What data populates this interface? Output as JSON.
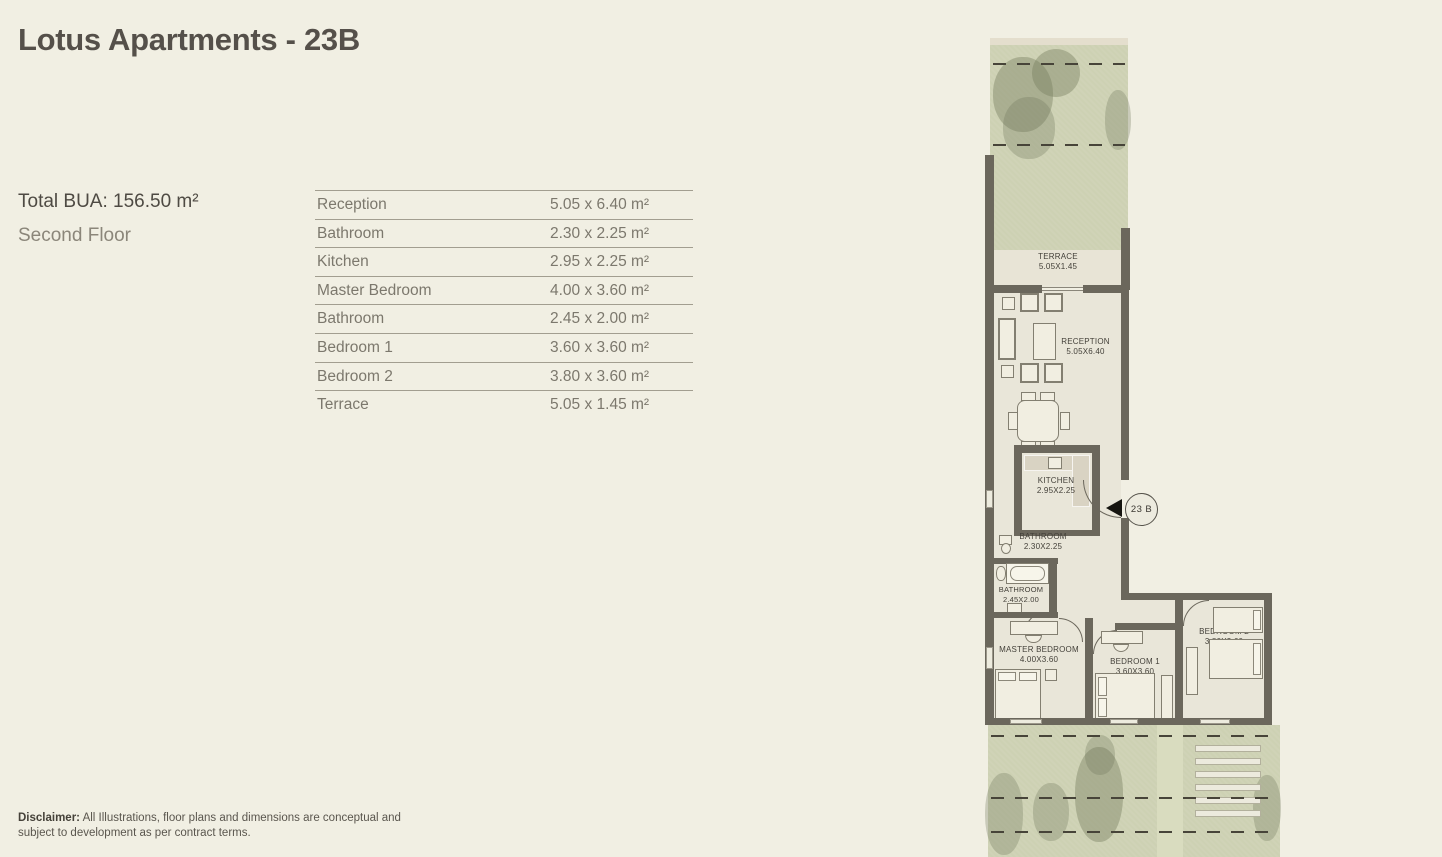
{
  "header": {
    "title": "Lotus Apartments - 23B"
  },
  "summary": {
    "total_bua": "Total BUA: 156.50 m²",
    "floor": "Second Floor"
  },
  "dimensions_table": {
    "rows": [
      {
        "label": "Reception",
        "value": "5.05 x 6.40 m²"
      },
      {
        "label": "Bathroom",
        "value": "2.30 x 2.25 m²"
      },
      {
        "label": "Kitchen",
        "value": "2.95 x 2.25 m²"
      },
      {
        "label": "Master Bedroom",
        "value": "4.00 x 3.60 m²"
      },
      {
        "label": "Bathroom",
        "value": "2.45 x 2.00 m²"
      },
      {
        "label": "Bedroom 1",
        "value": "3.60 x 3.60 m²"
      },
      {
        "label": "Bedroom 2",
        "value": "3.80 x 3.60 m²"
      },
      {
        "label": "Terrace",
        "value": "5.05 x 1.45 m²"
      }
    ]
  },
  "disclaimer": {
    "label": "Disclaimer:",
    "text": " All Illustrations, floor plans and dimensions are conceptual and subject to development as per contract terms."
  },
  "floor_plan": {
    "unit_badge": "23 B",
    "rooms": [
      {
        "name": "TERRACE",
        "dims": "5.05X1.45"
      },
      {
        "name": "RECEPTION",
        "dims": "5.05X6.40"
      },
      {
        "name": "KITCHEN",
        "dims": "2.95X2.25"
      },
      {
        "name": "BATHROOM",
        "dims": "2.30X2.25"
      },
      {
        "name": "BATHROOM",
        "dims": "2.45X2.00"
      },
      {
        "name": "MASTER BEDROOM",
        "dims": "4.00X3.60"
      },
      {
        "name": "BEDROOM 1",
        "dims": "3.60X3.60"
      },
      {
        "name": "BEDROOM 2",
        "dims": "3.80X3.60"
      }
    ],
    "colors": {
      "bg": "#f1efe3",
      "wall": "#6b675c",
      "floor": "#e9e6d9",
      "garden": "#cdd1b3",
      "plan-ink": "#44413a"
    }
  }
}
